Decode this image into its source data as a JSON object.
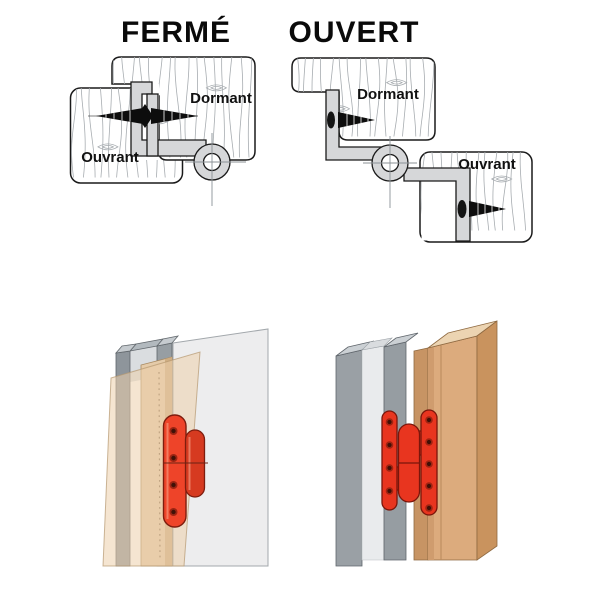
{
  "top": {
    "closed": {
      "title": "FERMÉ",
      "frame_label": "Dormant",
      "leaf_label": "Ouvrant"
    },
    "open": {
      "title": "OUVERT",
      "frame_label": "Dormant",
      "leaf_label": "Ouvrant"
    }
  },
  "colors": {
    "hinge_red": "#e8351f",
    "hinge_red_light": "#ee4429",
    "hinge_red_dark": "#7a160b",
    "knuckle_red": "#d63a20",
    "diagram_hinge_gray": "#d6d7d9",
    "metal_gray": "#9aa0a5",
    "metal_gray_light": "#cbd0d4",
    "wood_tan": "#dcab7d",
    "wood_tan_light": "#ecd4b2",
    "wood_tan_dark": "#c9935e",
    "jamb_tan": "#e5cba9",
    "panel_gray": "#ededee",
    "outline": "#1a1a1a"
  },
  "icons": {
    "screw": "screw-icon",
    "pivot": "hinge-pivot-crosshair-icon",
    "screw_holes": "screw-holes-dotted-line"
  }
}
